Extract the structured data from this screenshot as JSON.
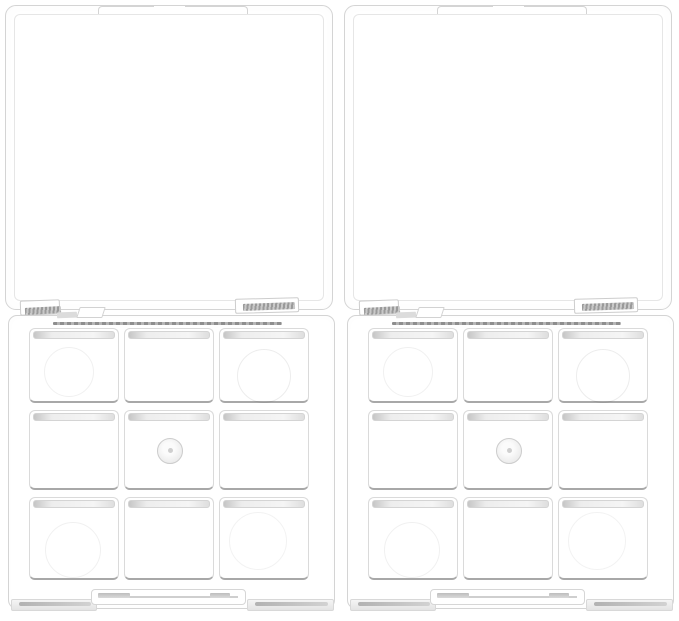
{
  "scene": {
    "type": "product-photograph",
    "description": "Two identical empty clear plastic makeup palette cases shown side by side on a white background, lids hinged open upward, each base holding a 3x3 grid of square empty compartments",
    "background_color": "#ffffff",
    "item_count": 2
  },
  "palettes": [
    {
      "id": "left",
      "label": "left empty 9-grid palette case",
      "lid_state": "open",
      "rows": 3,
      "cols": 3
    },
    {
      "id": "right",
      "label": "right empty 9-grid palette case",
      "lid_state": "open",
      "rows": 3,
      "cols": 3
    }
  ],
  "compartment_marks": {
    "round_well_cells": [
      "r1c1",
      "r1c3",
      "r3c1",
      "r3c3"
    ],
    "pivot_cell": "r2c2"
  },
  "colors": {
    "background": "#ffffff",
    "plastic_fill": "#ffffff",
    "edge_line": "#d4d4d4",
    "edge_line_light": "#e6e6e6",
    "edge_line_dark": "#a8a8a8",
    "hinge_metal": "#9a9a9a",
    "well_shadow": "rgba(0,0,0,0.06)"
  }
}
